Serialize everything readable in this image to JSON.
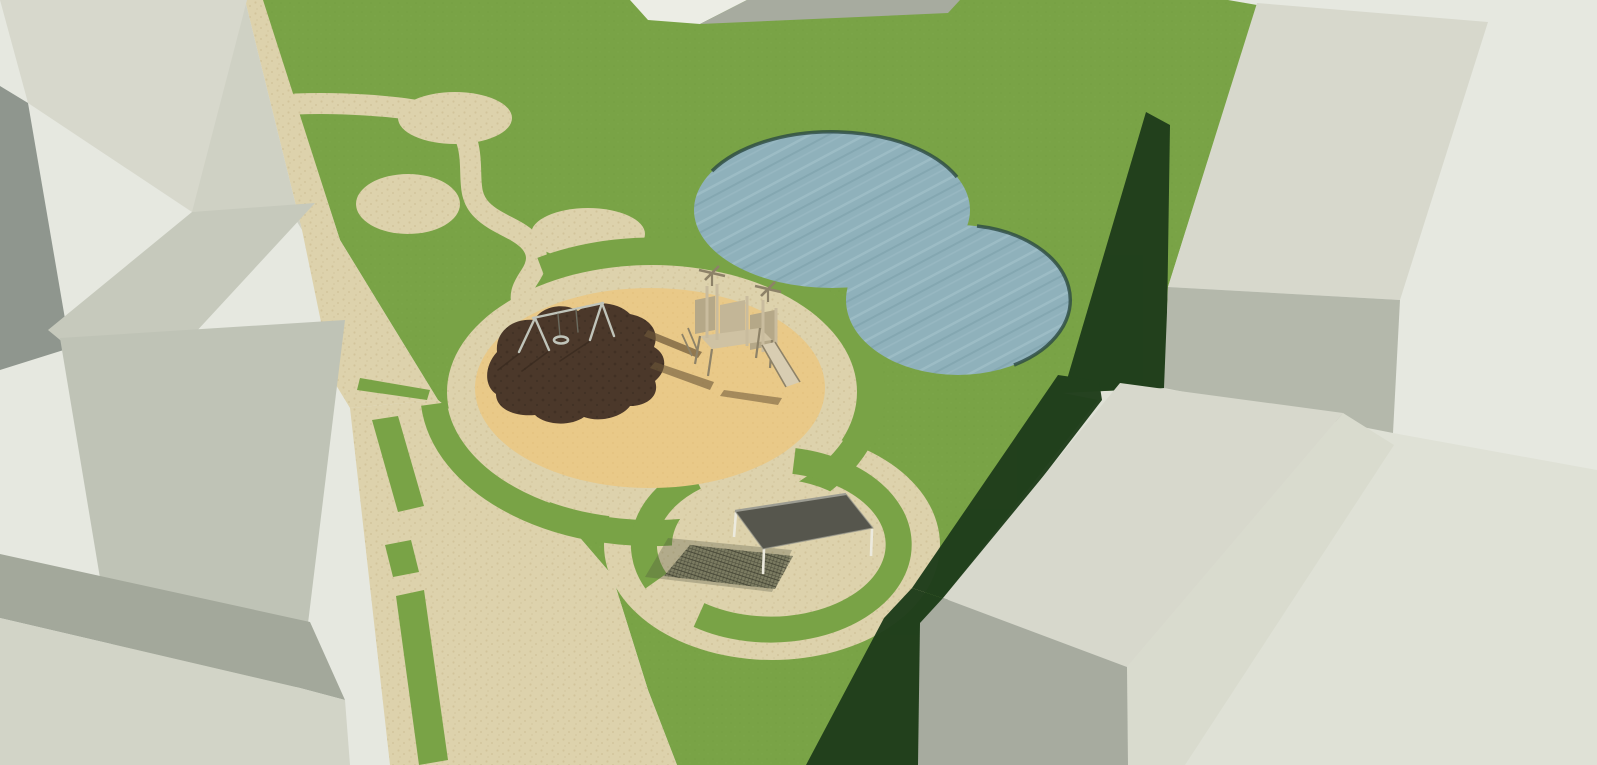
{
  "scene": {
    "description": "3D architectural render of a park and playground site plan surrounded by gray building blocks"
  },
  "colors": {
    "background": "#e6e8e0",
    "road": "#dfe1d6",
    "grass": "#79a346",
    "grass_dot": "#6f9a3e",
    "grass_dot2": "#84ad50",
    "shadow": "#1f3d1b",
    "path_base": "#ddd2ac",
    "path_dot": "#cfc096",
    "sand_base": "#e9c988",
    "sand_dot": "#ddba72",
    "mulch": "#4b382a",
    "mulch_dark": "#3a2b1f",
    "water": "#8fb1bb",
    "water_light": "#a5c3cb",
    "water_dark": "#7b9ea9",
    "pond_rim": "#2c4a44",
    "bldg_top_light": "#d7d8cc",
    "bldg_top_pale": "#ecede5",
    "bldg_strip": "#cfd1c4",
    "bldg_medium": "#b4b8ab",
    "bldg_gray": "#a7ab9f",
    "bldg_dark_side": "#8f968e",
    "bldg_band": "#a3a89b",
    "bldg_b_face": "#c6c9bc",
    "bldg_c_face": "#bfc3b6",
    "bldg_c_lower": "#b7bcaf",
    "bldg_f_right": "#d9dbce",
    "bldg_f_front": "#a7ab9f",
    "bldg_bl_main": "#d2d4c7",
    "metal": "#c0c4ba",
    "metal_dark": "#6b6b5f",
    "wood": "#c9bc9e",
    "wood_panel": "#b5a888",
    "wood_panel2": "#c3b697",
    "wood_deck": "#cfc2a3",
    "wood_light": "#d8cdb2",
    "wood_dark": "#8d8268",
    "equip_shadow": "#6b5638",
    "roof": "#56564d",
    "roof_edge": "#9c9c92",
    "pav_leg": "#eceade",
    "pav_shadow_soft": "#4f5340",
    "pav_shadow_grid": "#3e3f30"
  }
}
